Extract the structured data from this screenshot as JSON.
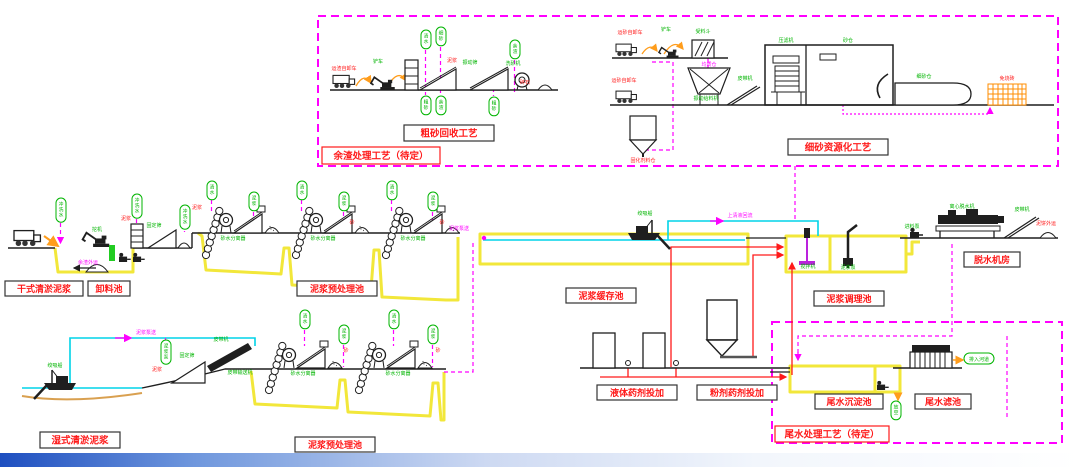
{
  "colors": {
    "magenta": "#ff00ff",
    "yellow": "#f2e73a",
    "cyan": "#00d4e8",
    "red": "#ff1a1a",
    "green": "#00b400",
    "orange": "#ff9d1c",
    "black": "#1f1f1f",
    "tan": "#d9a050",
    "grid_orange": "#ff8c00",
    "bar_blue": "#1e4fc0"
  },
  "label_boxes": [
    {
      "name": "residue-process-pending-label",
      "text": "余渣处理工艺（待定）",
      "x": 322,
      "y": 147,
      "w": 118,
      "h": 17,
      "border": "#ff1a1a",
      "fs": 9.5
    },
    {
      "name": "coarse-sand-recovery-label",
      "text": "粗砂回收工艺",
      "x": 404,
      "y": 125,
      "w": 90,
      "h": 16,
      "border": "#333333",
      "fs": 9.5
    },
    {
      "name": "fine-sand-utilization-label",
      "text": "细砂资源化工艺",
      "x": 788,
      "y": 139,
      "w": 100,
      "h": 16,
      "border": "#333333",
      "fs": 9.5
    },
    {
      "name": "dry-dredging-mud-label",
      "text": "干式清淤泥浆",
      "x": 5,
      "y": 281,
      "w": 78,
      "h": 15,
      "border": "#333333",
      "fs": 9
    },
    {
      "name": "unloading-pool-label",
      "text": "卸料池",
      "x": 88,
      "y": 281,
      "w": 42,
      "h": 15,
      "border": "#333333",
      "fs": 9
    },
    {
      "name": "pretreatment-pool-1-label",
      "text": "泥浆预处理池",
      "x": 297,
      "y": 281,
      "w": 80,
      "h": 15,
      "border": "#333333",
      "fs": 9
    },
    {
      "name": "buffer-pool-label",
      "text": "泥浆缓存池",
      "x": 566,
      "y": 288,
      "w": 70,
      "h": 15,
      "border": "#333333",
      "fs": 9
    },
    {
      "name": "conditioning-pool-label",
      "text": "泥浆调理池",
      "x": 814,
      "y": 291,
      "w": 70,
      "h": 15,
      "border": "#333333",
      "fs": 9
    },
    {
      "name": "dewatering-room-label",
      "text": "脱水机房",
      "x": 964,
      "y": 252,
      "w": 56,
      "h": 15,
      "border": "#333333",
      "fs": 9
    },
    {
      "name": "wet-dredging-mud-label",
      "text": "湿式清淤泥浆",
      "x": 40,
      "y": 432,
      "w": 80,
      "h": 16,
      "border": "#333333",
      "fs": 9.5
    },
    {
      "name": "pretreatment-pool-2-label",
      "text": "泥浆预处理池",
      "x": 295,
      "y": 437,
      "w": 80,
      "h": 15,
      "border": "#333333",
      "fs": 9
    },
    {
      "name": "liquid-chemical-dosing-label",
      "text": "液体药剂投加",
      "x": 597,
      "y": 385,
      "w": 80,
      "h": 15,
      "border": "#333333",
      "fs": 9
    },
    {
      "name": "powder-chemical-dosing-label",
      "text": "粉剂药剂投加",
      "x": 697,
      "y": 385,
      "w": 80,
      "h": 15,
      "border": "#333333",
      "fs": 9
    },
    {
      "name": "tailwater-sedimentation-pool-label",
      "text": "尾水沉淀池",
      "x": 815,
      "y": 394,
      "w": 68,
      "h": 15,
      "border": "#333333",
      "fs": 9
    },
    {
      "name": "tailwater-filter-pool-label",
      "text": "尾水滤池",
      "x": 915,
      "y": 394,
      "w": 56,
      "h": 15,
      "border": "#333333",
      "fs": 9
    },
    {
      "name": "tailwater-process-pending-label",
      "text": "尾水处理工艺（待定）",
      "x": 775,
      "y": 426,
      "w": 114,
      "h": 16,
      "border": "#ff1a1a",
      "fs": 9.5
    }
  ],
  "capsules": [
    {
      "n": "capsule-wash-water-1",
      "t": "清水",
      "x": 421,
      "y": 30
    },
    {
      "n": "capsule-fine-sand",
      "t": "细砂",
      "x": 436,
      "y": 27
    },
    {
      "n": "capsule-coarse-sand-1",
      "t": "粗砂",
      "x": 421,
      "y": 96
    },
    {
      "n": "capsule-residue-1",
      "t": "余渣",
      "x": 436,
      "y": 96
    },
    {
      "n": "capsule-coarse-sand-2",
      "t": "粗砂",
      "x": 489,
      "y": 97
    },
    {
      "n": "capsule-residue-2",
      "t": "余渣",
      "x": 510,
      "y": 40
    },
    {
      "n": "capsule-flush-water-1",
      "t": "冲洗水",
      "x": 56,
      "y": 198
    },
    {
      "n": "capsule-flush-water-2",
      "t": "冲洗水",
      "x": 132,
      "y": 194
    },
    {
      "n": "capsule-flush-water-3",
      "t": "冲洗水",
      "x": 180,
      "y": 205
    },
    {
      "n": "capsule-clear-water-1",
      "t": "清水",
      "x": 207,
      "y": 181
    },
    {
      "n": "capsule-slurry-1",
      "t": "泥浆",
      "x": 249,
      "y": 192
    },
    {
      "n": "capsule-clear-water-2",
      "t": "清水",
      "x": 297,
      "y": 181
    },
    {
      "n": "capsule-slurry-2",
      "t": "泥浆",
      "x": 339,
      "y": 192
    },
    {
      "n": "capsule-clear-water-3",
      "t": "清水",
      "x": 387,
      "y": 181
    },
    {
      "n": "capsule-slurry-3",
      "t": "泥浆",
      "x": 428,
      "y": 192
    },
    {
      "n": "capsule-slurry-pump",
      "t": "泥浆泵",
      "x": 161,
      "y": 340
    },
    {
      "n": "capsule-clear-water-4",
      "t": "清水",
      "x": 300,
      "y": 310
    },
    {
      "n": "capsule-slurry-4",
      "t": "泥浆",
      "x": 339,
      "y": 325
    },
    {
      "n": "capsule-clear-water-5",
      "t": "清水",
      "x": 389,
      "y": 310
    },
    {
      "n": "capsule-slurry-5",
      "t": "泥浆",
      "x": 428,
      "y": 325
    },
    {
      "n": "capsule-drain",
      "t": "放空",
      "x": 891,
      "y": 401
    },
    {
      "n": "capsule-discharge-to-river",
      "t": "排入河道",
      "x": 964,
      "y": 353,
      "h": true
    }
  ],
  "small_labels": [
    {
      "n": "label-dump-truck-1",
      "t": "运渣自卸车",
      "x": 344,
      "y": 70,
      "c": "r"
    },
    {
      "n": "label-loader-1",
      "t": "铲车",
      "x": 378,
      "y": 63,
      "c": "g"
    },
    {
      "n": "label-slurry-a",
      "t": "泥浆",
      "x": 452,
      "y": 62,
      "c": "r"
    },
    {
      "n": "label-vibrating-screen",
      "t": "振动筛",
      "x": 470,
      "y": 64,
      "c": "g"
    },
    {
      "n": "label-sand-washer",
      "t": "洗砂机",
      "x": 513,
      "y": 65,
      "c": "g"
    },
    {
      "n": "label-gravel",
      "t": "碎石",
      "x": 525,
      "y": 84,
      "c": "r"
    },
    {
      "n": "label-dump-truck-2",
      "t": "运砂自卸车",
      "x": 630,
      "y": 34,
      "c": "r"
    },
    {
      "n": "label-loader-2",
      "t": "铲车",
      "x": 666,
      "y": 31,
      "c": "g"
    },
    {
      "n": "label-receiving-hopper",
      "t": "受料斗",
      "x": 703,
      "y": 33,
      "c": "g"
    },
    {
      "n": "label-dump-truck-3",
      "t": "运砂自卸车",
      "x": 624,
      "y": 82,
      "c": "r"
    },
    {
      "n": "label-homogenizing-bin",
      "t": "均质仓",
      "x": 709,
      "y": 66,
      "c": "m"
    },
    {
      "n": "label-vibrating-feeder",
      "t": "振动给料机",
      "x": 706,
      "y": 100,
      "c": "g"
    },
    {
      "n": "label-belt-conveyor-1",
      "t": "皮带机",
      "x": 745,
      "y": 80,
      "c": "g"
    },
    {
      "n": "label-filter-press",
      "t": "压滤机",
      "x": 786,
      "y": 42,
      "c": "g"
    },
    {
      "n": "label-sand-bin",
      "t": "砂仓",
      "x": 848,
      "y": 42,
      "c": "g"
    },
    {
      "n": "label-fine-sand-store",
      "t": "细砂仓",
      "x": 924,
      "y": 78,
      "c": "g"
    },
    {
      "n": "label-brick-yard",
      "t": "免烧砖",
      "x": 1007,
      "y": 80,
      "c": "r"
    },
    {
      "n": "label-solidifier-silo",
      "t": "固化剂料仓",
      "x": 643,
      "y": 162,
      "c": "r"
    },
    {
      "n": "label-excavator",
      "t": "挖机",
      "x": 97,
      "y": 231,
      "c": "g"
    },
    {
      "n": "label-residue-out",
      "t": "余渣外运",
      "x": 88,
      "y": 264,
      "c": "m"
    },
    {
      "n": "label-slurry-b",
      "t": "泥浆",
      "x": 126,
      "y": 220,
      "c": "r"
    },
    {
      "n": "label-fixed-screen-1",
      "t": "固定筛",
      "x": 154,
      "y": 227,
      "c": "g"
    },
    {
      "n": "label-slurry-c",
      "t": "泥浆",
      "x": 197,
      "y": 209,
      "c": "r"
    },
    {
      "n": "label-separator-1",
      "t": "砂水分离器",
      "x": 233,
      "y": 240,
      "c": "g"
    },
    {
      "n": "label-separator-2",
      "t": "砂水分离器",
      "x": 323,
      "y": 240,
      "c": "g"
    },
    {
      "n": "label-separator-3",
      "t": "砂水分离器",
      "x": 413,
      "y": 240,
      "c": "g"
    },
    {
      "n": "label-sand-1",
      "t": "砂",
      "x": 352,
      "y": 224,
      "c": "r"
    },
    {
      "n": "label-sand-2",
      "t": "砂",
      "x": 442,
      "y": 224,
      "c": "r"
    },
    {
      "n": "label-slurry-pumping-1",
      "t": "泥浆泵送",
      "x": 459,
      "y": 230,
      "c": "m"
    },
    {
      "n": "label-dredger-1",
      "t": "绞吸船",
      "x": 645,
      "y": 215,
      "c": "g"
    },
    {
      "n": "label-supernatant-return",
      "t": "上清液回流",
      "x": 740,
      "y": 217,
      "c": "m"
    },
    {
      "n": "label-mixer",
      "t": "搅拌机",
      "x": 808,
      "y": 268,
      "c": "g"
    },
    {
      "n": "label-slurry-pump-2",
      "t": "泥浆泵",
      "x": 848,
      "y": 269,
      "c": "g"
    },
    {
      "n": "label-feed-pump",
      "t": "进料泵",
      "x": 912,
      "y": 228,
      "c": "g"
    },
    {
      "n": "label-centrifuge",
      "t": "离心脱水机",
      "x": 962,
      "y": 208,
      "c": "g"
    },
    {
      "n": "label-belt-conveyor-2",
      "t": "皮带机",
      "x": 1022,
      "y": 211,
      "c": "g"
    },
    {
      "n": "label-mud-cake-out",
      "t": "泥饼外运",
      "x": 1046,
      "y": 225,
      "c": "r"
    },
    {
      "n": "label-dredger-2",
      "t": "绞吸船",
      "x": 55,
      "y": 367,
      "c": "g"
    },
    {
      "n": "label-slurry-pumping-2",
      "t": "泥浆泵送",
      "x": 146,
      "y": 334,
      "c": "m"
    },
    {
      "n": "label-slurry-d",
      "t": "泥浆",
      "x": 157,
      "y": 371,
      "c": "r"
    },
    {
      "n": "label-fixed-screen-2",
      "t": "固定筛",
      "x": 187,
      "y": 357,
      "c": "g"
    },
    {
      "n": "label-belt-conveyor-3",
      "t": "皮带机",
      "x": 221,
      "y": 341,
      "c": "g"
    },
    {
      "n": "label-belt-conveyor-4",
      "t": "皮带输送机",
      "x": 240,
      "y": 374,
      "c": "g"
    },
    {
      "n": "label-separator-4",
      "t": "砂水分离器",
      "x": 303,
      "y": 375,
      "c": "g"
    },
    {
      "n": "label-separator-5",
      "t": "砂水分离器",
      "x": 398,
      "y": 375,
      "c": "g"
    },
    {
      "n": "label-sand-3",
      "t": "砂",
      "x": 346,
      "y": 352,
      "c": "r"
    },
    {
      "n": "label-sand-4",
      "t": "砂",
      "x": 438,
      "y": 352,
      "c": "r"
    }
  ]
}
